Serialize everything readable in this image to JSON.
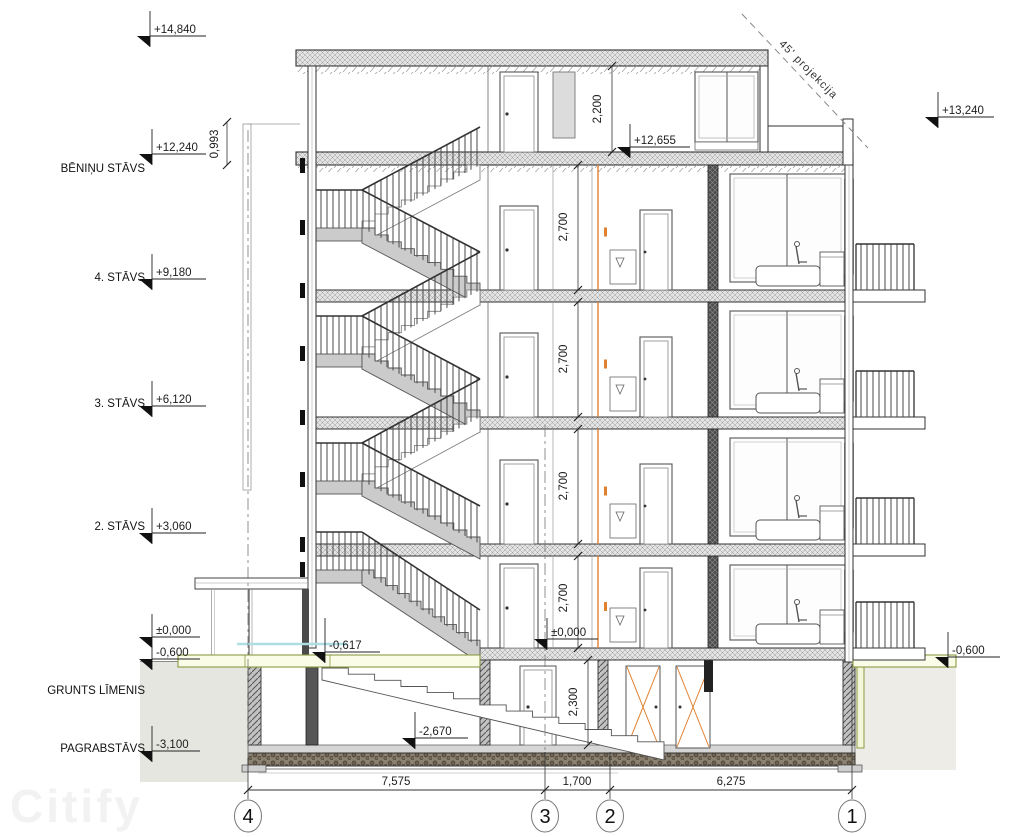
{
  "watermark": "Citify",
  "projection_note": "45' projekcija",
  "floor_labels": [
    {
      "label": "BĒNIŅU STĀVS",
      "elev": "+12,240"
    },
    {
      "label": "4. STĀVS",
      "elev": "+9,180"
    },
    {
      "label": "3. STĀVS",
      "elev": "+6,120"
    },
    {
      "label": "2. STĀVS",
      "elev": "+3,060"
    },
    {
      "label": "GRUNTS LĪMENIS",
      "elev": ""
    },
    {
      "label": "PAGRABSTĀVS",
      "elev": "-3,100"
    }
  ],
  "elevations": {
    "roof_top": "+14,840",
    "parapet_right": "+13,240",
    "attic_interior": "+12,655",
    "zero_left": "±0,000",
    "minus_600_left": "-0,600",
    "zero_interior": "±0,000",
    "minus_600_right": "-0,600",
    "entry_landing": "-0,617",
    "basement_stair": "-2,670"
  },
  "vertical_dims": {
    "parapet": "0,993",
    "attic_room_height": "2,200",
    "floor_height": "2,700",
    "basement_height": "2,300"
  },
  "horizontal_dims": [
    {
      "value": "7,575"
    },
    {
      "value": "1,700"
    },
    {
      "value": "6,275"
    }
  ],
  "grid_axes": [
    {
      "id": "4"
    },
    {
      "id": "3"
    },
    {
      "id": "2"
    },
    {
      "id": "1"
    }
  ]
}
